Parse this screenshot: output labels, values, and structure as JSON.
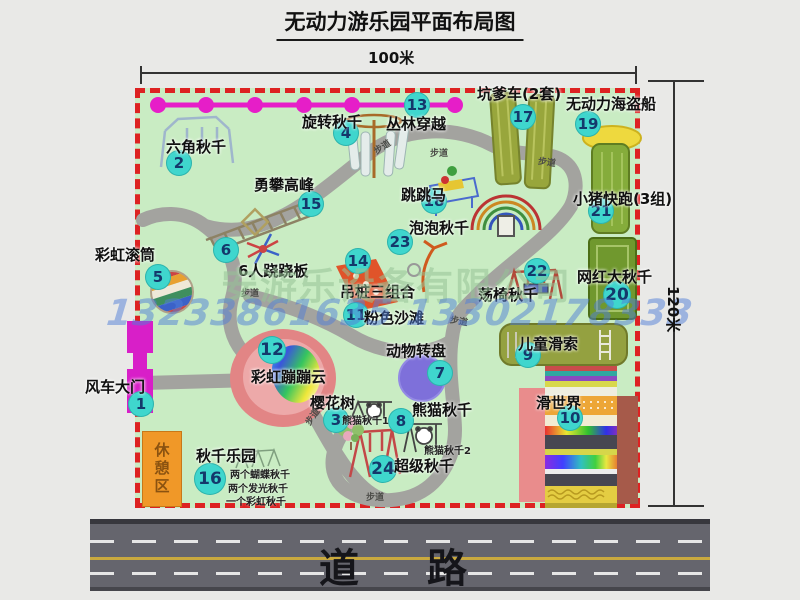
{
  "title": "无动力游乐园平面布局图",
  "dimensions": {
    "top": "100米",
    "right": "120米"
  },
  "road": {
    "label": "道　路"
  },
  "watermark": {
    "company": "安游乐设备有限公司",
    "phone": "13233861635 13302178333"
  },
  "rest_area": {
    "label": "休憩区"
  },
  "trail_label": "步道",
  "colors": {
    "map_green": "#c9ecc3",
    "border_red": "#dd2222",
    "badge_teal": "#3fd6cd",
    "badge_text": "#14386b",
    "zipline_magenta": "#e61ec8",
    "gate_magenta": "#d81fc8",
    "rest_orange": "#f09828",
    "road_gray": "#65656d"
  },
  "attractions": [
    {
      "num": 1,
      "label": "风车大门",
      "badge": {
        "x": 141,
        "y": 404
      },
      "text": {
        "x": 85,
        "y": 376
      }
    },
    {
      "num": 2,
      "label": "六角秋千",
      "badge": {
        "x": 179,
        "y": 163
      },
      "text": {
        "x": 166,
        "y": 136
      }
    },
    {
      "num": 3,
      "label": "樱花树",
      "badge": {
        "x": 336,
        "y": 420
      },
      "text": {
        "x": 310,
        "y": 392
      }
    },
    {
      "num": 4,
      "label": "旋转秋千",
      "badge": {
        "x": 346,
        "y": 133
      },
      "text": {
        "x": 302,
        "y": 111
      }
    },
    {
      "num": 5,
      "label": "彩虹滚筒",
      "badge": {
        "x": 158,
        "y": 277
      },
      "text": {
        "x": 95,
        "y": 244
      }
    },
    {
      "num": 6,
      "label": "6人跷跷板",
      "badge": {
        "x": 226,
        "y": 250
      },
      "text": {
        "x": 238,
        "y": 260
      }
    },
    {
      "num": 7,
      "label": "动物转盘",
      "badge": {
        "x": 440,
        "y": 373
      },
      "text": {
        "x": 386,
        "y": 340
      }
    },
    {
      "num": 8,
      "label": "熊猫秋千",
      "badge": {
        "x": 401,
        "y": 421
      },
      "text": {
        "x": 412,
        "y": 399
      }
    },
    {
      "num": 9,
      "label": "儿童滑索",
      "badge": {
        "x": 528,
        "y": 355
      },
      "text": {
        "x": 518,
        "y": 333
      }
    },
    {
      "num": 10,
      "label": "滑世界",
      "badge": {
        "x": 570,
        "y": 418
      },
      "text": {
        "x": 536,
        "y": 392
      }
    },
    {
      "num": 11,
      "label": "粉色沙滩",
      "badge": {
        "x": 356,
        "y": 315
      },
      "text": {
        "x": 364,
        "y": 307
      }
    },
    {
      "num": 12,
      "label": "彩虹蹦蹦云",
      "badge": {
        "x": 272,
        "y": 350
      },
      "size": 28,
      "text": {
        "x": 251,
        "y": 366
      }
    },
    {
      "num": 13,
      "label": "丛林穿越",
      "badge": {
        "x": 417,
        "y": 105
      },
      "text": {
        "x": 386,
        "y": 113
      }
    },
    {
      "num": 14,
      "label": "吊桩三组合",
      "badge": {
        "x": 358,
        "y": 261
      },
      "text": {
        "x": 340,
        "y": 281
      }
    },
    {
      "num": 15,
      "label": "勇攀高峰",
      "badge": {
        "x": 311,
        "y": 204
      },
      "text": {
        "x": 254,
        "y": 174
      }
    },
    {
      "num": 16,
      "label": "秋千乐园",
      "badge": {
        "x": 210,
        "y": 479
      },
      "size": 32,
      "text": {
        "x": 196,
        "y": 445
      }
    },
    {
      "num": 17,
      "label": "坑爹车(2套)",
      "badge": {
        "x": 523,
        "y": 117
      },
      "text": {
        "x": 477,
        "y": 83
      }
    },
    {
      "num": 18,
      "label": "跳跳马",
      "badge": {
        "x": 434,
        "y": 201
      },
      "text": {
        "x": 401,
        "y": 184
      }
    },
    {
      "num": 19,
      "label": "无动力海盗船",
      "badge": {
        "x": 588,
        "y": 124
      },
      "text": {
        "x": 566,
        "y": 93
      }
    },
    {
      "num": 20,
      "label": "网红大秋千",
      "badge": {
        "x": 617,
        "y": 295
      },
      "size": 28,
      "text": {
        "x": 577,
        "y": 266
      }
    },
    {
      "num": 21,
      "label": "小猪快跑(3组)",
      "badge": {
        "x": 601,
        "y": 211
      },
      "text": {
        "x": 573,
        "y": 188
      }
    },
    {
      "num": 22,
      "label": "荡椅秋千",
      "badge": {
        "x": 537,
        "y": 271
      },
      "text": {
        "x": 478,
        "y": 284
      }
    },
    {
      "num": 23,
      "label": "泡泡秋千",
      "badge": {
        "x": 400,
        "y": 242
      },
      "text": {
        "x": 409,
        "y": 217
      }
    },
    {
      "num": 24,
      "label": "超级秋千",
      "badge": {
        "x": 383,
        "y": 469
      },
      "size": 28,
      "text": {
        "x": 394,
        "y": 455
      }
    }
  ],
  "notes": [
    {
      "text": "熊猫秋千1",
      "x": 342,
      "y": 412
    },
    {
      "text": "熊猫秋千2",
      "x": 424,
      "y": 442
    },
    {
      "text": "两个蝴蝶秋千",
      "x": 230,
      "y": 466
    },
    {
      "text": "两个发光秋千",
      "x": 228,
      "y": 480
    },
    {
      "text": "一个彩虹秋千",
      "x": 226,
      "y": 493
    }
  ],
  "trail_positions": [
    {
      "x": 373,
      "y": 140,
      "r": -33
    },
    {
      "x": 430,
      "y": 146,
      "r": 0
    },
    {
      "x": 538,
      "y": 155,
      "r": 8
    },
    {
      "x": 241,
      "y": 286,
      "r": 0
    },
    {
      "x": 303,
      "y": 410,
      "r": -55
    },
    {
      "x": 366,
      "y": 490,
      "r": 0
    },
    {
      "x": 450,
      "y": 314,
      "r": 10
    }
  ]
}
